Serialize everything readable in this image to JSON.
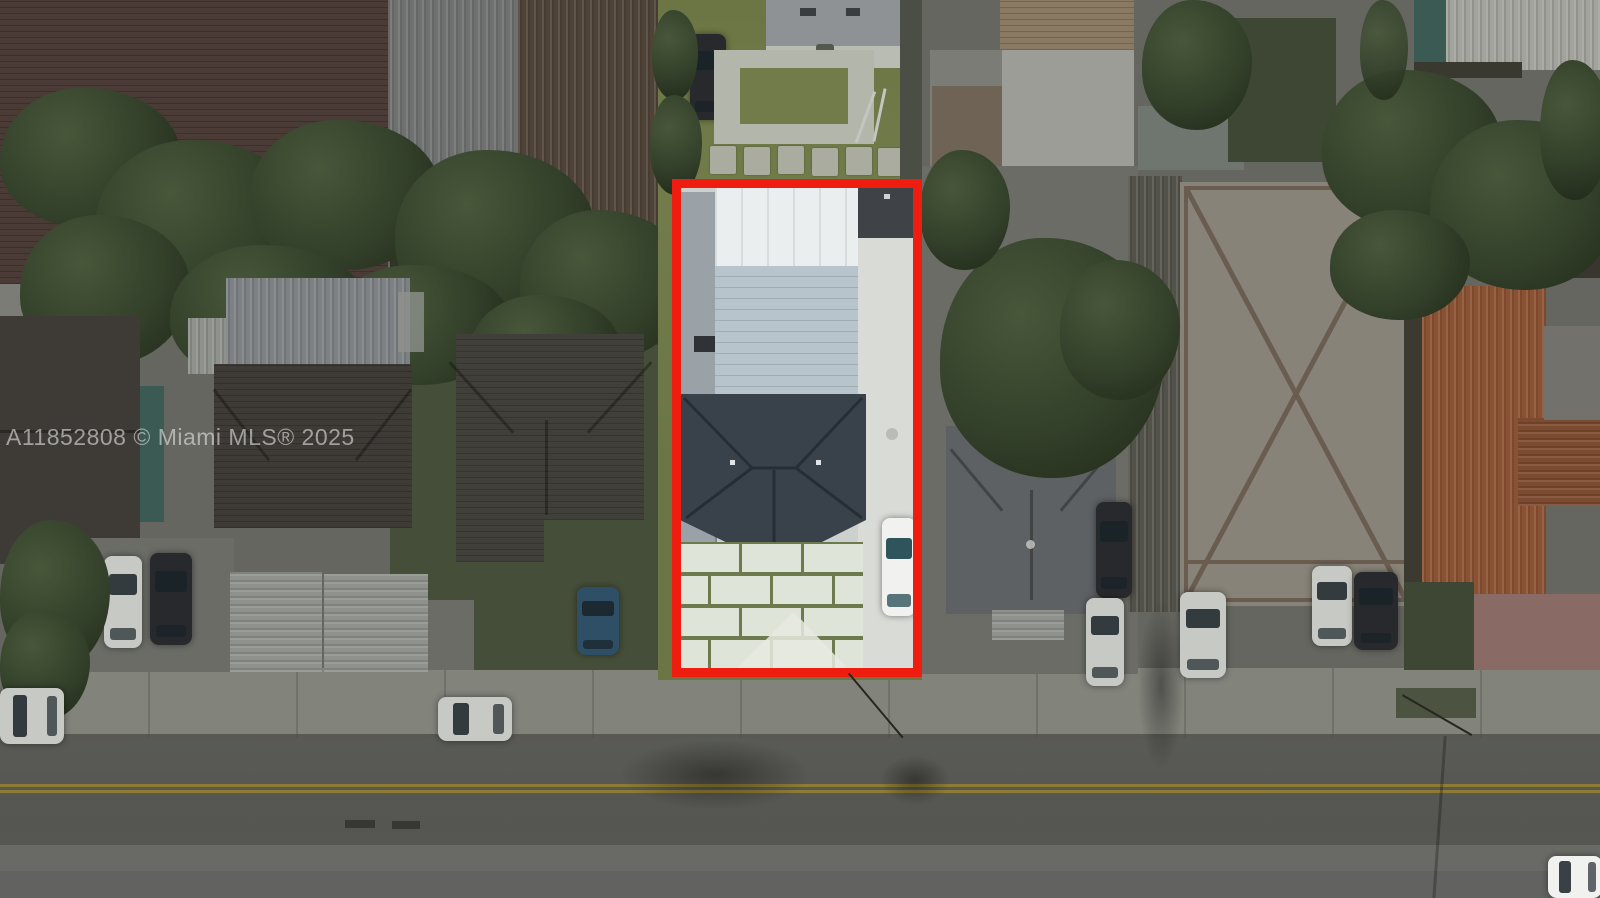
{
  "watermark": {
    "text": "A11852808 © Miami MLS® 2025"
  },
  "property_outline": {
    "color_name": "red",
    "shape": "rectangle"
  },
  "colors": {
    "outline-red": "#ee1d10",
    "watermark": "#e9e9e9",
    "ground-dark": "#65665f",
    "road": "#595a55",
    "road-light": "#6c6d67",
    "road-bottom": "#626360",
    "sidewalk": "#82837b",
    "curb": "#4e4f49",
    "yellow-line": "#97822f",
    "tree-dark": "#242d1c",
    "tree-mid": "#33402a",
    "tree-light": "#48573a",
    "grass-dark": "#3e4733",
    "lawn-mid": "#454e38",
    "bright-grass": "#6b7644",
    "bright-grass-2": "#727c4b",
    "roof-maroon": "#4a3b36",
    "roof-dark": "#3e3b36",
    "roof-dark-2": "#413f39",
    "roof-gray": "#5d6164",
    "metal-gray": "#7d8184",
    "corr-strip": "#6e7170",
    "rust": "#4f4338",
    "concrete-dark": "#6b6c66",
    "concrete-mid": "#7b7c75",
    "white-dim": "#c7c9c4",
    "carport-white": "#8f918c",
    "white-bldg": "#9c9d96",
    "tan-top": "#8a7a63",
    "white-roof-corner": "#a2a39c",
    "teal-wall": "#3c5a54",
    "fence-dark": "#4b4e44",
    "fence-strip": "#53524a",
    "paver-diamond": "#878378",
    "diamond-line": "#6b5c50",
    "tile-orange": "#8a5133",
    "tile-orange2": "#7b4a2f",
    "pink-concrete": "#8a6a65",
    "subject-white-roof": "#eaeeef",
    "subject-panel": "#b7c4cc",
    "subject-slope": "#9aa2a8",
    "shingle-dark": "#39424b",
    "shingle-ridge": "#262d34",
    "paver-light": "#dfe4d9",
    "paver-grout": "#6d7a4e",
    "paver-mound": "#e7eadf",
    "walkway": "#d9dcd6",
    "interior-concrete": "#ccd1cd",
    "shed-dark": "#3f4347",
    "patio": "#b9bcb3",
    "path": "#b3b7ab",
    "stone": "#a9ac9e",
    "car-white": "#f1f2f0",
    "car-black": "#27292c",
    "car-blue": "#2f4f66",
    "glass-teal": "#2f545c",
    "wire": "#26261f"
  }
}
